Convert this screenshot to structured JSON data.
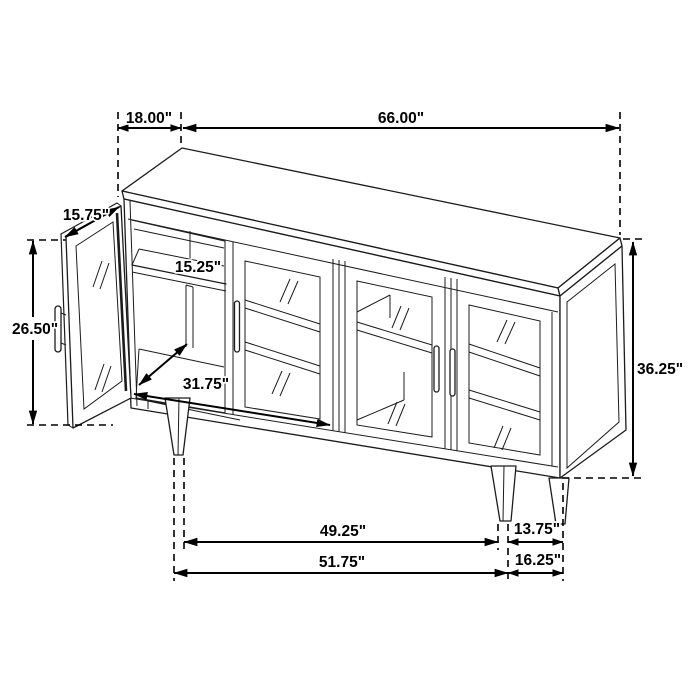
{
  "diagram": {
    "subject": "four-door sideboard cabinet technical dimension drawing",
    "background": "#ffffff",
    "line_color": "#1c1c1c",
    "dimension_color": "#000000"
  },
  "dim": {
    "top_depth": "18.00\"",
    "top_width": "66.00\"",
    "door_width": "15.75\"",
    "door_height": "26.50\"",
    "shelf_depth": "15.25\"",
    "interior_width": "31.75\"",
    "overall_height": "36.25\"",
    "front_legs_inner": "49.25\"",
    "side_legs_span": "13.75\"",
    "front_legs_outer": "51.75\"",
    "side_depth_bottom": "16.25\""
  }
}
